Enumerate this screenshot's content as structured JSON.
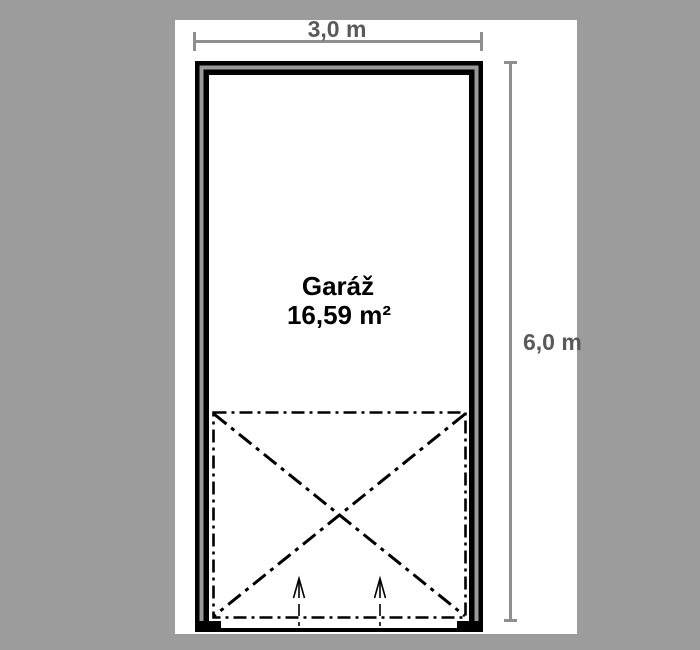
{
  "drawing": {
    "room": {
      "name": "Garáž",
      "area": "16,59 m²"
    },
    "dimensions": {
      "width_label": "3,0 m",
      "height_label": "6,0 m"
    },
    "colors": {
      "background": "#9c9c9c",
      "sheet": "#ffffff",
      "wall_black": "#000000",
      "wall_core_gray": "#9a9a9a",
      "dimension_line": "#8f8f8f",
      "dimension_text": "#595959",
      "room_text": "#000000"
    }
  }
}
